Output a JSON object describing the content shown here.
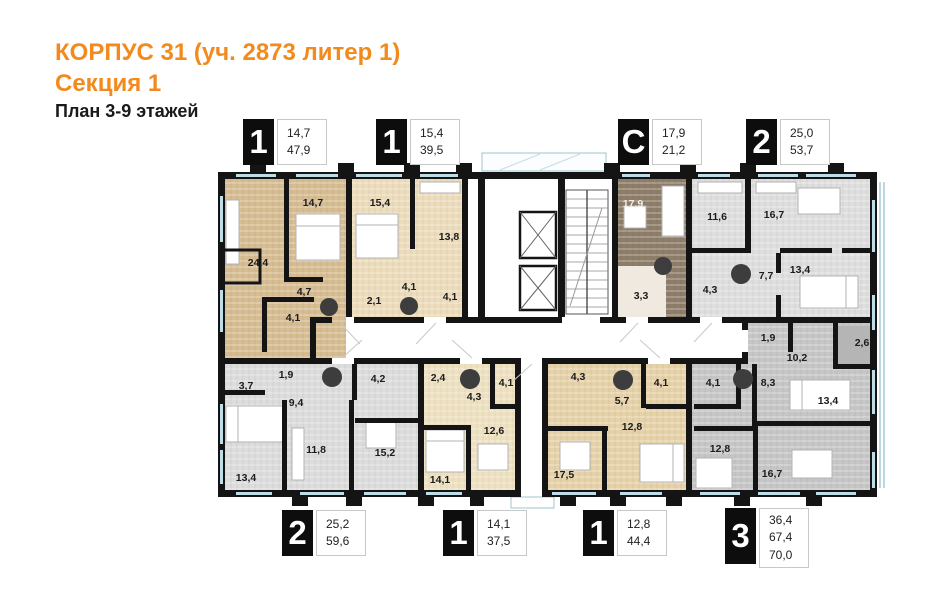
{
  "header": {
    "building": "КОРПУС 31 (уч. 2873 литер 1)",
    "section": "Секция 1",
    "floors": "План 3-9 этажей"
  },
  "colors": {
    "accent_orange": "#f28a1e",
    "wall_black": "#141414",
    "beige_dark": "#d6bc91",
    "beige_light": "#ecdcbb",
    "beige_mid": "#e6d2a9",
    "cream": "#eee1c2",
    "taupe_studio": "#8d7d69",
    "gray_light": "#dedede",
    "gray_mid": "#dcdcdc",
    "gray_dark": "#c6c6c6",
    "glazing_blue": "#bfdde6",
    "shaft_circle": "#3d3d3d"
  },
  "legend_top": [
    {
      "type": "1",
      "areas": [
        "14,7",
        "47,9"
      ]
    },
    {
      "type": "1",
      "areas": [
        "15,4",
        "39,5"
      ]
    },
    {
      "type": "С",
      "areas": [
        "17,9",
        "21,2"
      ]
    },
    {
      "type": "2",
      "areas": [
        "25,0",
        "53,7"
      ]
    }
  ],
  "legend_bottom": [
    {
      "type": "2",
      "areas": [
        "25,2",
        "59,6"
      ]
    },
    {
      "type": "1",
      "areas": [
        "14,1",
        "37,5"
      ]
    },
    {
      "type": "1",
      "areas": [
        "12,8",
        "44,4"
      ]
    },
    {
      "type": "3",
      "areas": [
        "36,4",
        "67,4",
        "70,0"
      ]
    }
  ],
  "rooms": {
    "t1a": [
      "24,4",
      "14,7",
      "4,7",
      "4,1"
    ],
    "t1b": [
      "15,4",
      "13,8",
      "2,1",
      "4,1",
      "4,1"
    ],
    "st": [
      "17,9",
      "3,3"
    ],
    "t2": [
      "11,6",
      "16,7",
      "4,3",
      "7,7",
      "13,4"
    ],
    "b2": [
      "3,7",
      "1,9",
      "9,4",
      "4,2",
      "13,4",
      "11,8",
      "15,2"
    ],
    "b1a": [
      "2,4",
      "4,3",
      "4,1",
      "12,6",
      "14,1"
    ],
    "b1b": [
      "4,3",
      "5,7",
      "4,1",
      "17,5",
      "12,8"
    ],
    "b3": [
      "1,9",
      "10,2",
      "2,6",
      "4,1",
      "8,3",
      "13,4",
      "12,8",
      "16,7"
    ]
  }
}
